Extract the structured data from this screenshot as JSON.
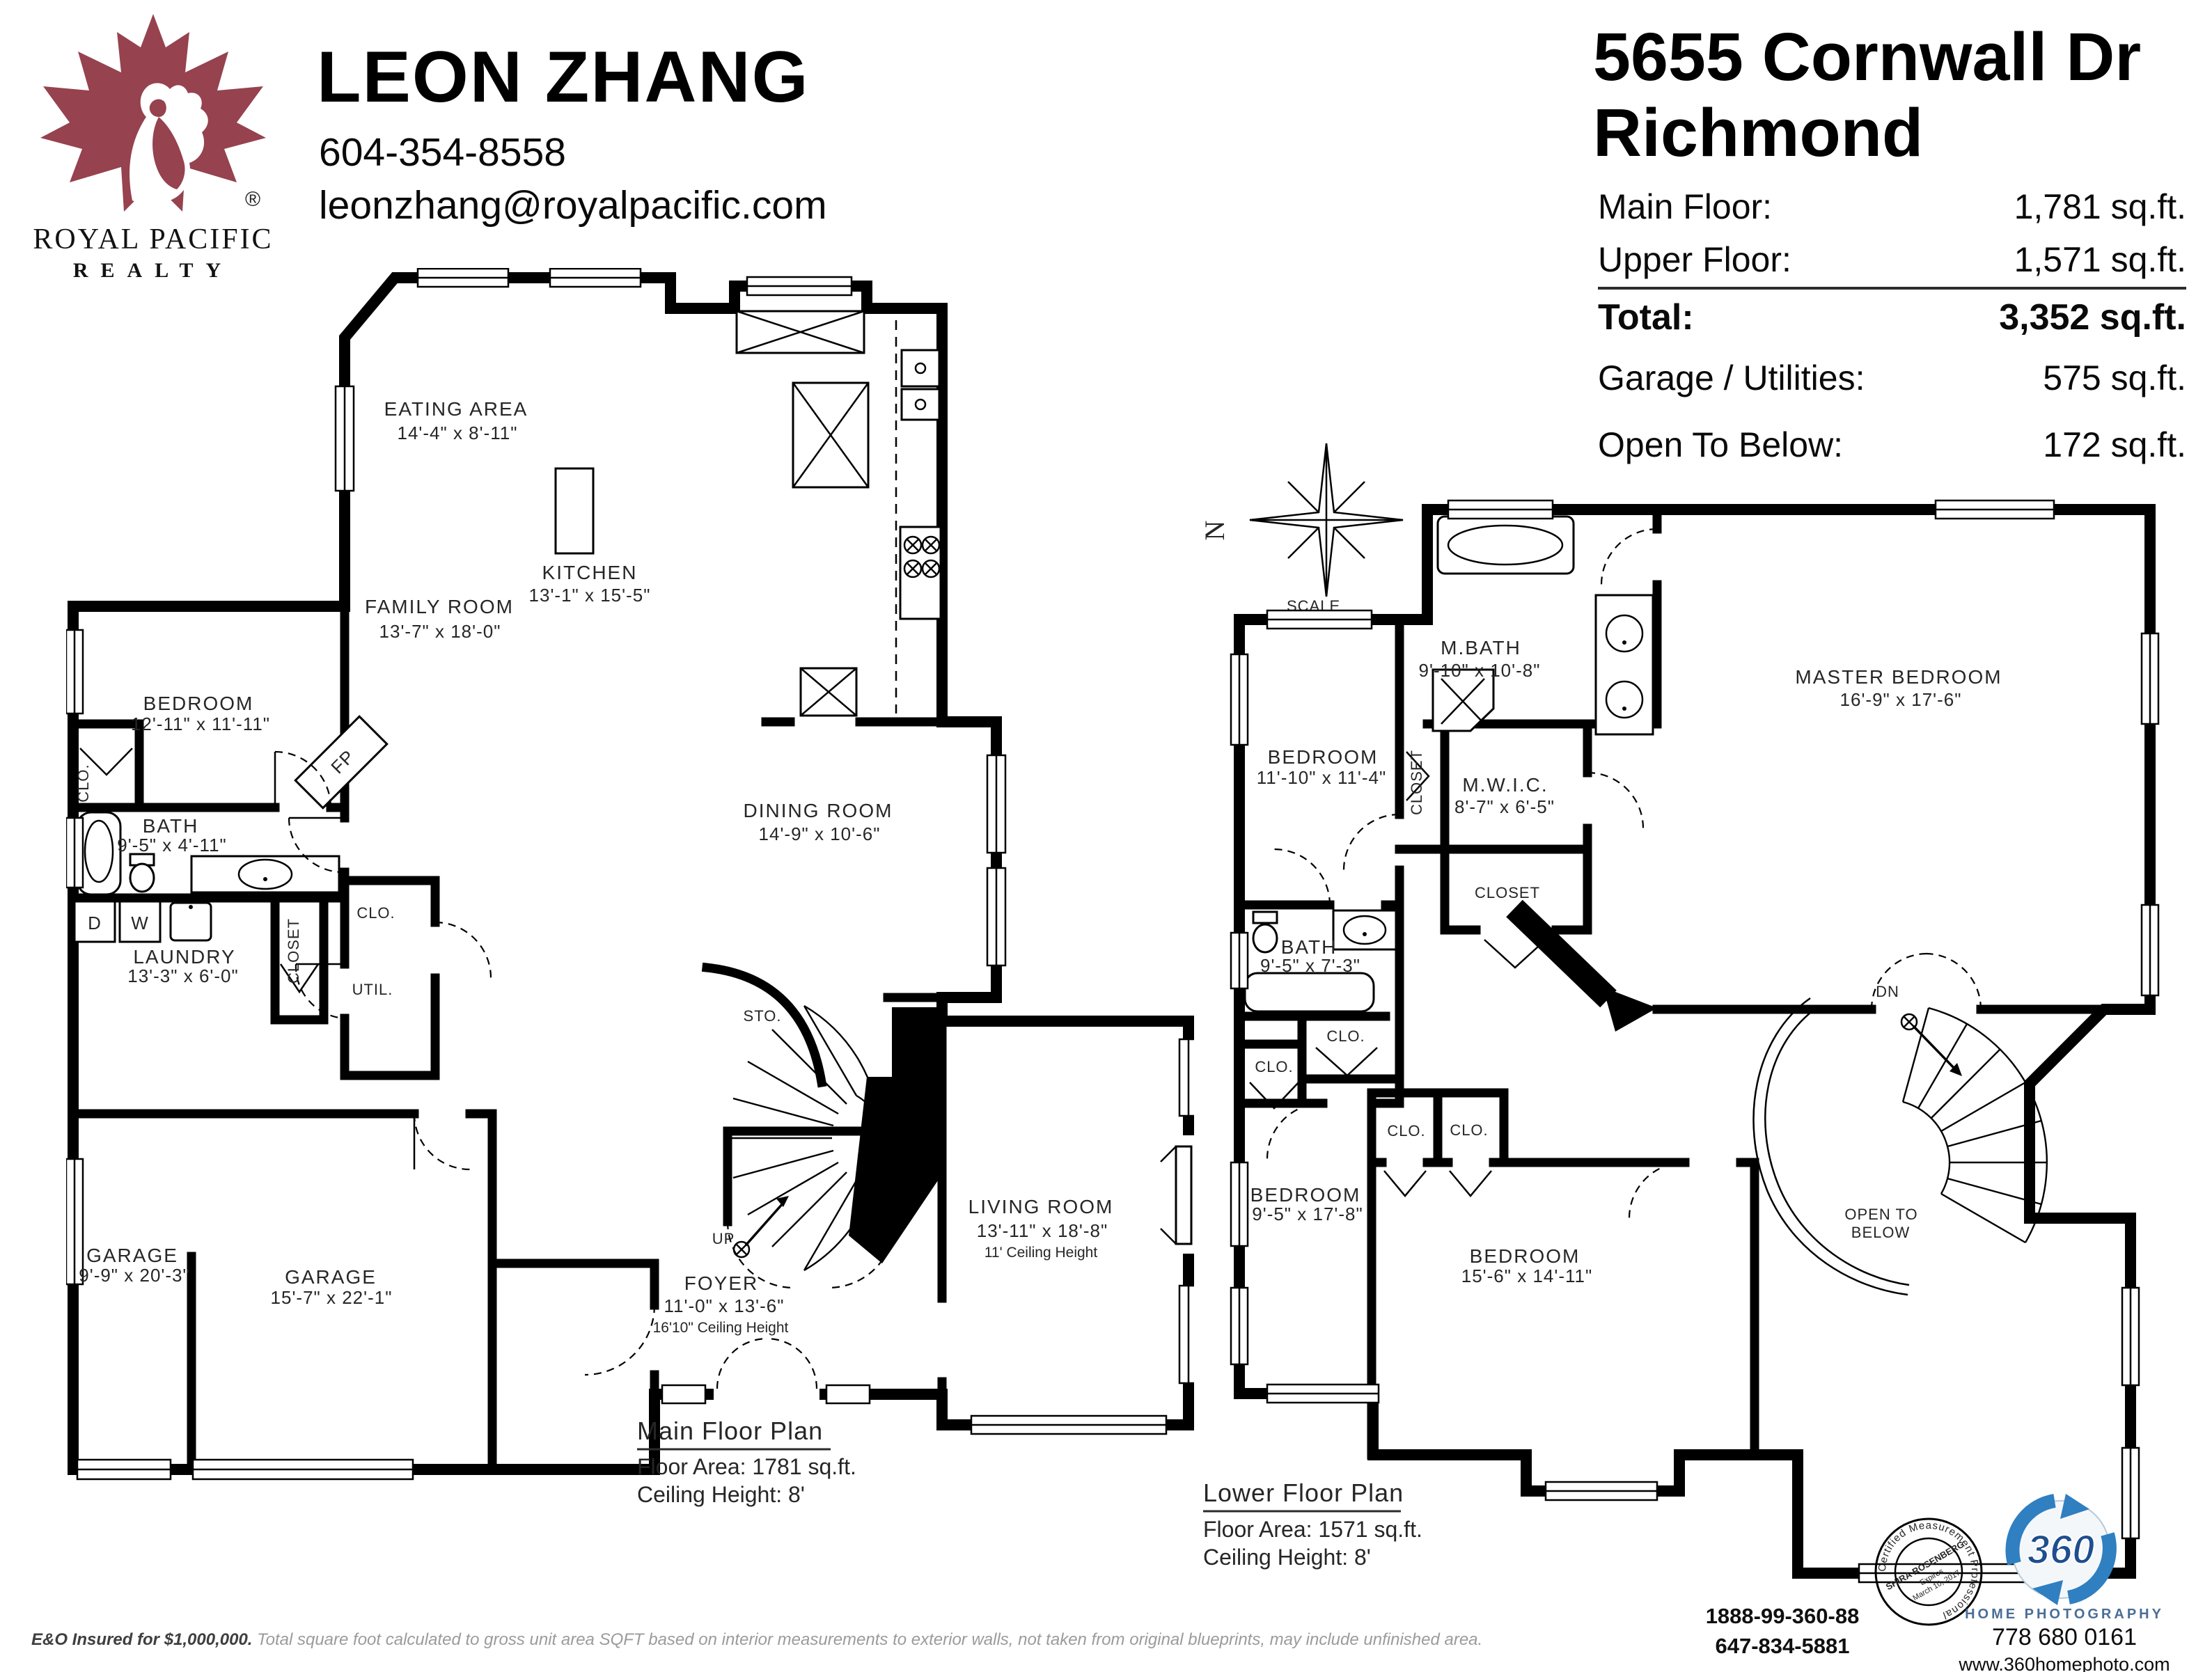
{
  "header": {
    "brand": {
      "line1": "ROYAL PACIFIC",
      "line2": "REALTY",
      "reg": "®"
    },
    "agent": {
      "name": "LEON ZHANG",
      "phone": "604-354-8558",
      "email": "leonzhang@royalpacific.com"
    },
    "listing": {
      "address": "5655 Cornwall Dr",
      "city": "Richmond"
    },
    "areas": {
      "rows": [
        {
          "label": "Main Floor:",
          "value": "1,781 sq.ft."
        },
        {
          "label": "Upper Floor:",
          "value": "1,571 sq.ft."
        },
        {
          "label": "Total:",
          "value": "3,352 sq.ft."
        },
        {
          "label": "Garage / Utilities:",
          "value": "575 sq.ft."
        },
        {
          "label": "Open To Below:",
          "value": "172 sq.ft."
        }
      ]
    }
  },
  "compass": {
    "north": "N",
    "scale_label": "SCALE",
    "scale_start": "0'",
    "scale_end": "5'"
  },
  "glossary": {
    "clo": "CLO.",
    "closet": "CLOSET",
    "util": "UTIL.",
    "sto": "STO.",
    "up": "UP",
    "dn": "DN",
    "fp": "FP",
    "dryer": "D",
    "washer": "W",
    "open_to": "OPEN TO",
    "below": "BELOW"
  },
  "main_plan": {
    "rooms": [
      {
        "name": "EATING AREA",
        "dims": "14'-4\" x 8'-11\""
      },
      {
        "name": "KITCHEN",
        "dims": "13'-1\" x 15'-5\""
      },
      {
        "name": "FAMILY ROOM",
        "dims": "13'-7\" x 18'-0\""
      },
      {
        "name": "BEDROOM",
        "dims": "12'-11\" x 11'-11\""
      },
      {
        "name": "DINING ROOM",
        "dims": "14'-9\" x 10'-6\""
      },
      {
        "name": "BATH",
        "dims": "9'-5\" x 4'-11\""
      },
      {
        "name": "LAUNDRY",
        "dims": "13'-3\" x 6'-0\""
      },
      {
        "name": "GARAGE",
        "dims": "9'-9\" x 20'-3\""
      },
      {
        "name": "GARAGE",
        "dims": "15'-7\" x 22'-1\""
      },
      {
        "name": "FOYER",
        "dims": "11'-0\" x 13'-6\"",
        "note": "16'10\" Ceiling Height"
      },
      {
        "name": "LIVING ROOM",
        "dims": "13'-11\" x 18'-8\"",
        "note": "11' Ceiling Height"
      }
    ],
    "caption": {
      "title": "Main Floor Plan",
      "area": "Floor Area: 1781 sq.ft.",
      "ceiling": "Ceiling Height: 8'"
    }
  },
  "upper_plan": {
    "rooms": [
      {
        "name": "M.BATH",
        "dims": "9'-10\" x 10'-8\""
      },
      {
        "name": "MASTER BEDROOM",
        "dims": "16'-9\" x 17'-6\""
      },
      {
        "name": "BEDROOM",
        "dims": "11'-10\" x 11'-4\""
      },
      {
        "name": "M.W.I.C.",
        "dims": "8'-7\" x 6'-5\""
      },
      {
        "name": "BATH",
        "dims": "9'-5\" x 7'-3\""
      },
      {
        "name": "BEDROOM",
        "dims": "9'-5\" x 17'-8\""
      },
      {
        "name": "BEDROOM",
        "dims": "15'-6\" x 14'-11\""
      }
    ],
    "caption": {
      "title": "Lower Floor Plan",
      "area": "Floor Area: 1571 sq.ft.",
      "ceiling": "Ceiling Height: 8'"
    }
  },
  "footer": {
    "disclaimer_lead": "E&O Insured for $1,000,000.",
    "disclaimer_body": "Total square foot calculated to gross unit area SQFT based on interior measurements to exterior walls, not taken from original blueprints, may include unfinished area.",
    "phone_toll": "1888-99-360-88",
    "phone_alt": "647-834-5881",
    "photography": {
      "logo_number": "360",
      "name": "HOME PHOTOGRAPHY",
      "phone": "778 680 0161",
      "website": "www.360homephoto.com"
    },
    "stamp": {
      "ring_text": "Certified Measurement Professional",
      "name": "SHIRA ROSENBERG",
      "expires_label": "Expires",
      "expires_date": "March 10, 2017"
    }
  },
  "colors": {
    "brand_maroon": "#96424f",
    "logo_blue": "#2f7fc1",
    "ink": "#000000",
    "gray_text": "#9b9b9b"
  }
}
